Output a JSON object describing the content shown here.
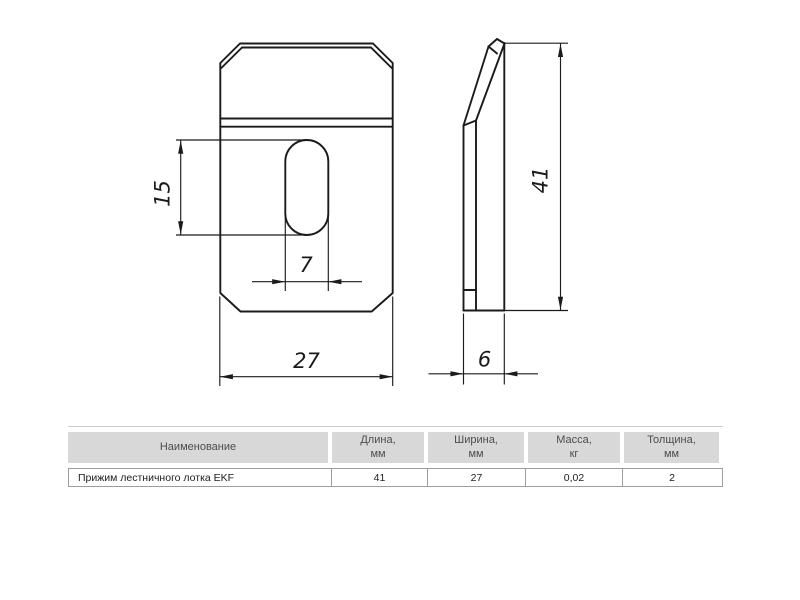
{
  "drawing": {
    "dims": {
      "slot_height": "15",
      "slot_width": "7",
      "plate_width": "27",
      "plate_height": "41",
      "profile_depth": "6"
    }
  },
  "table": {
    "headers": [
      {
        "line1": "Наименование",
        "line2": ""
      },
      {
        "line1": "Длина,",
        "line2": "мм"
      },
      {
        "line1": "Ширина,",
        "line2": "мм"
      },
      {
        "line1": "Масса,",
        "line2": "кг"
      },
      {
        "line1": "Толщина,",
        "line2": "мм"
      }
    ],
    "row": {
      "name": "Прижим лестничного лотка EKF",
      "length": "41",
      "width": "27",
      "mass": "0,02",
      "thickness": "2"
    }
  }
}
